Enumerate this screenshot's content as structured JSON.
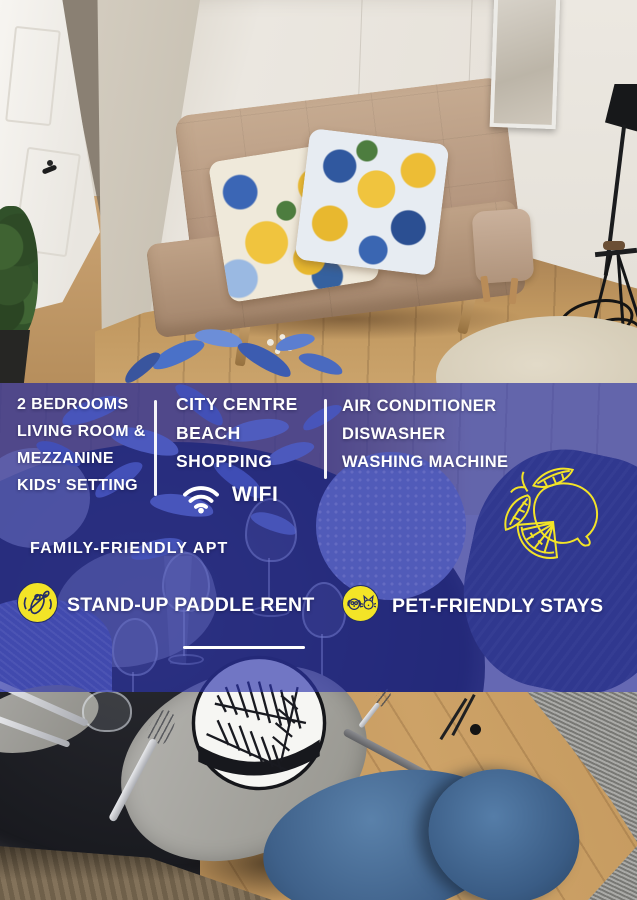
{
  "colors": {
    "overlay_blue": "#2c34ab",
    "accent_yellow": "#f3e427",
    "icon_line_navy": "#232d66",
    "text_white": "#ffffff"
  },
  "overlay": {
    "left_column": {
      "lines": [
        "2 BEDROOMS",
        "LIVING ROOM &",
        "MEZZANINE",
        "KIDS' SETTING"
      ]
    },
    "middle_column": {
      "lines": [
        "CITY CENTRE",
        "BEACH",
        "SHOPPING"
      ],
      "wifi_label": "WIFI"
    },
    "right_column": {
      "lines": [
        "AIR CONDITIONER",
        "DISWASHER",
        "WASHING MACHINE"
      ]
    },
    "family_label": "FAMILY-FRIENDLY APT",
    "features": [
      {
        "icon": "stand-up-paddle-icon",
        "label": "STAND-UP PADDLE RENT"
      },
      {
        "icon": "pet-icon",
        "label": "PET-FRIENDLY STAYS"
      }
    ],
    "icons": {
      "wifi": "wifi-icon",
      "lemon": "lemon-line-art-illustration"
    }
  }
}
